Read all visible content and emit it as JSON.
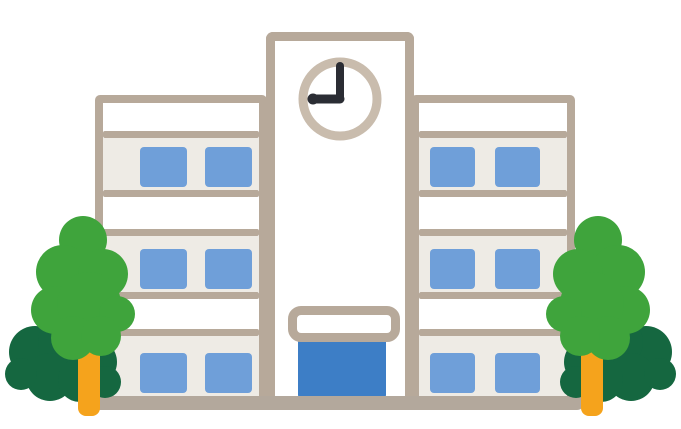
{
  "scene": {
    "description": "Cartoon clip-art illustration of a white three-story school building with a central clock tower showing 9:00, blue windows, a blue entrance door under a white canopy, and a pair of green trees (light green front crown, dark green back crown, orange trunk) on each side"
  },
  "palette": {
    "background": "#ffffff",
    "outline_tan": "#b7a99a",
    "wall_white": "#ffffff",
    "floor_gray": "#eeebe5",
    "window_blue": "#6f9fd9",
    "door_blue": "#3d7ec6",
    "clock_ring": "#c9bcad",
    "clock_face": "#ffffff",
    "clock_hands": "#2b2d34",
    "tree_light_green": "#3fa43c",
    "tree_dark_green": "#156740",
    "trunk_orange": "#f5a31c",
    "ground_tan": "#b3a89c"
  },
  "building": {
    "wings": [
      {
        "id": "left",
        "floors": 3,
        "windows_per_floor": 2
      },
      {
        "id": "right",
        "floors": 3,
        "windows_per_floor": 2
      }
    ],
    "tower": {
      "clock_time": "9:00",
      "has_entrance_canopy": true,
      "has_blue_door": true
    }
  },
  "trees": [
    {
      "id": "left",
      "front_crown": "light green",
      "back_crown": "dark green",
      "trunk": "orange"
    },
    {
      "id": "right",
      "front_crown": "light green",
      "back_crown": "dark green",
      "trunk": "orange"
    }
  ]
}
